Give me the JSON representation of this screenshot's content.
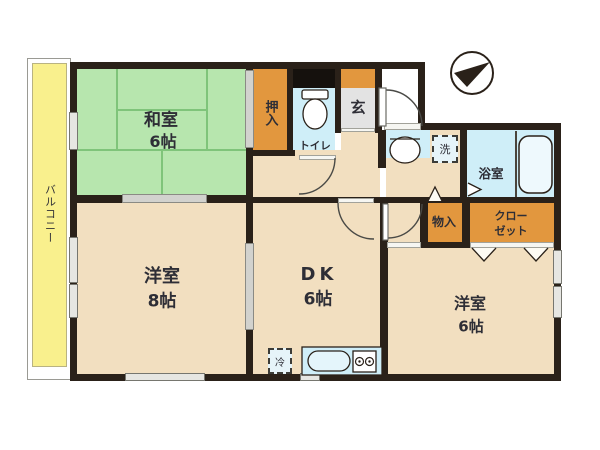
{
  "plan_type": "floorplan",
  "palette": {
    "wall": "#2a2119",
    "room_floor": "#f2dfc0",
    "tatami_green": "#b7e6ae",
    "wet_area_blue": "#cfeef8",
    "closet_orange": "#e2973e",
    "balcony_yellow": "#f9f08d",
    "genkan_gray": "#e3e3e3"
  },
  "rooms": {
    "balcony": {
      "name": "バルコニー"
    },
    "washitsu": {
      "name": "和室",
      "size": "6帖"
    },
    "oshiire": {
      "name": "押入"
    },
    "toilet": {
      "name": "トイレ"
    },
    "genkan": {
      "name": "玄"
    },
    "bathroom": {
      "name": "浴室"
    },
    "laundry": {
      "name": "洗"
    },
    "closet": {
      "name_line1": "クロー",
      "name_line2": "ゼット"
    },
    "monoire": {
      "name": "物入"
    },
    "yoshitsu8": {
      "name": "洋室",
      "size": "8帖"
    },
    "dk": {
      "name": "DK",
      "size": "6帖"
    },
    "yoshitsu6": {
      "name": "洋室",
      "size": "6帖"
    },
    "fridge": {
      "name": "冷"
    }
  }
}
